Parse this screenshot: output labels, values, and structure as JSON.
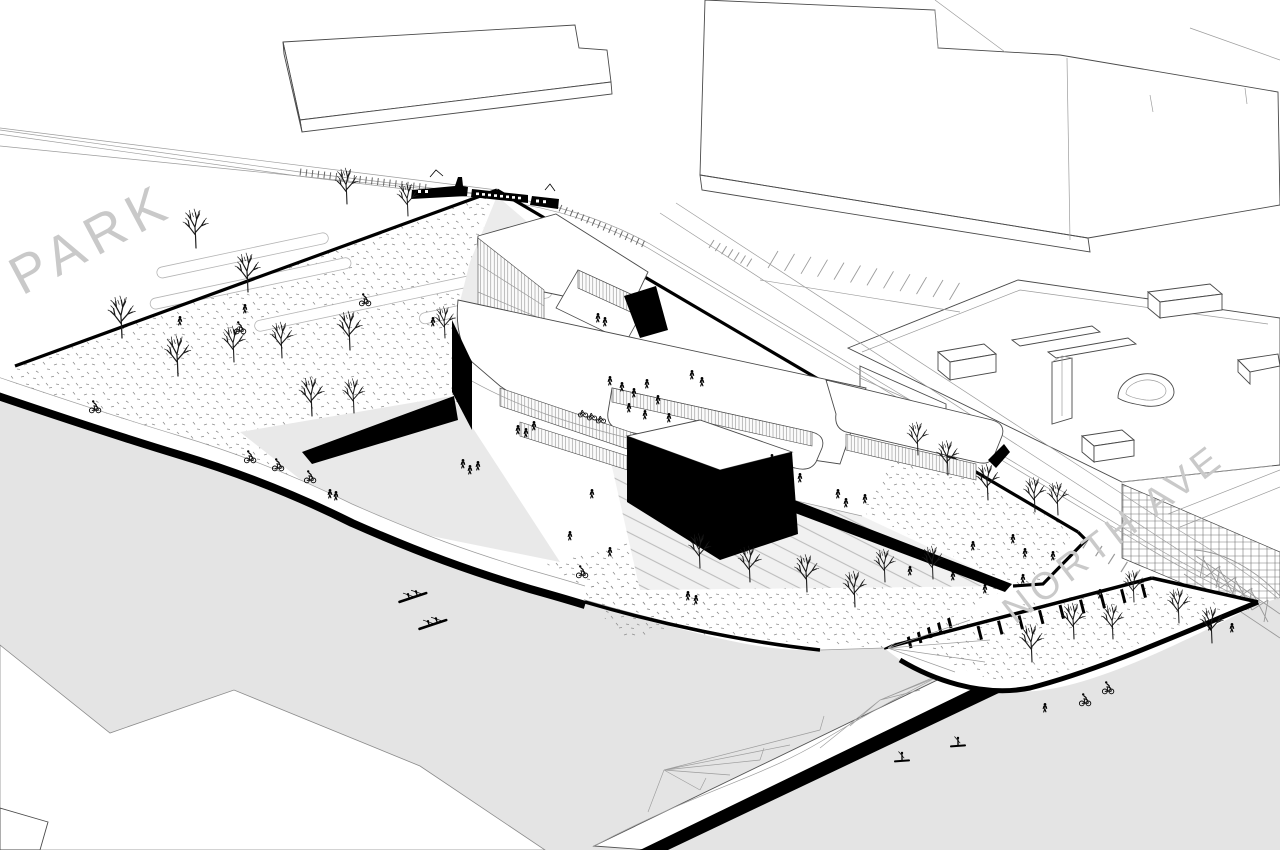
{
  "labels": {
    "park": "PARK",
    "north_ave": "NORTH AVE"
  },
  "colors": {
    "ink": "#000000",
    "outline": "#4a4a4a",
    "faint": "#9c9c9c",
    "river": "#e4e4e4",
    "path_gray": "#ececec",
    "slope_gray": "#e9e9e9",
    "glass": "#8a8a8a",
    "label_gray": "#c9c9c9",
    "paper": "#ffffff"
  },
  "scene": {
    "trees": [
      {
        "x": 347,
        "y": 204,
        "s": 1.2
      },
      {
        "x": 408,
        "y": 216,
        "s": 1.1
      },
      {
        "x": 196,
        "y": 248,
        "s": 1.3
      },
      {
        "x": 248,
        "y": 292,
        "s": 1.3
      },
      {
        "x": 122,
        "y": 338,
        "s": 1.4
      },
      {
        "x": 178,
        "y": 376,
        "s": 1.35
      },
      {
        "x": 234,
        "y": 362,
        "s": 1.2
      },
      {
        "x": 282,
        "y": 358,
        "s": 1.2
      },
      {
        "x": 350,
        "y": 350,
        "s": 1.3
      },
      {
        "x": 312,
        "y": 416,
        "s": 1.3
      },
      {
        "x": 354,
        "y": 413,
        "s": 1.15
      },
      {
        "x": 445,
        "y": 338,
        "s": 1.05
      },
      {
        "x": 918,
        "y": 455,
        "s": 1.1
      },
      {
        "x": 948,
        "y": 475,
        "s": 1.15
      },
      {
        "x": 988,
        "y": 500,
        "s": 1.2
      },
      {
        "x": 1035,
        "y": 512,
        "s": 1.15
      },
      {
        "x": 1058,
        "y": 515,
        "s": 1.1
      },
      {
        "x": 700,
        "y": 568,
        "s": 1.15
      },
      {
        "x": 750,
        "y": 582,
        "s": 1.2
      },
      {
        "x": 807,
        "y": 592,
        "s": 1.25
      },
      {
        "x": 855,
        "y": 607,
        "s": 1.2
      },
      {
        "x": 885,
        "y": 582,
        "s": 1.1
      },
      {
        "x": 933,
        "y": 579,
        "s": 1.1
      },
      {
        "x": 1032,
        "y": 662,
        "s": 1.25
      },
      {
        "x": 1074,
        "y": 639,
        "s": 1.2
      },
      {
        "x": 1113,
        "y": 639,
        "s": 1.15
      },
      {
        "x": 1134,
        "y": 602,
        "s": 1.05
      },
      {
        "x": 1179,
        "y": 623,
        "s": 1.15
      },
      {
        "x": 1212,
        "y": 643,
        "s": 1.2
      }
    ],
    "people": [
      {
        "x": 610,
        "y": 385
      },
      {
        "x": 622,
        "y": 391
      },
      {
        "x": 634,
        "y": 397
      },
      {
        "x": 647,
        "y": 388
      },
      {
        "x": 658,
        "y": 404
      },
      {
        "x": 629,
        "y": 412
      },
      {
        "x": 645,
        "y": 419
      },
      {
        "x": 669,
        "y": 422
      },
      {
        "x": 692,
        "y": 379
      },
      {
        "x": 702,
        "y": 386
      },
      {
        "x": 598,
        "y": 322
      },
      {
        "x": 605,
        "y": 326
      },
      {
        "x": 518,
        "y": 434
      },
      {
        "x": 526,
        "y": 437
      },
      {
        "x": 534,
        "y": 430
      },
      {
        "x": 463,
        "y": 468
      },
      {
        "x": 470,
        "y": 474
      },
      {
        "x": 478,
        "y": 470
      },
      {
        "x": 592,
        "y": 498
      },
      {
        "x": 570,
        "y": 540
      },
      {
        "x": 610,
        "y": 556
      },
      {
        "x": 688,
        "y": 600
      },
      {
        "x": 696,
        "y": 604
      },
      {
        "x": 772,
        "y": 463
      },
      {
        "x": 778,
        "y": 467
      },
      {
        "x": 786,
        "y": 475
      },
      {
        "x": 800,
        "y": 482
      },
      {
        "x": 838,
        "y": 498
      },
      {
        "x": 846,
        "y": 507
      },
      {
        "x": 865,
        "y": 503
      },
      {
        "x": 783,
        "y": 515
      },
      {
        "x": 973,
        "y": 550
      },
      {
        "x": 1013,
        "y": 543
      },
      {
        "x": 1025,
        "y": 557
      },
      {
        "x": 1053,
        "y": 560
      },
      {
        "x": 910,
        "y": 575
      },
      {
        "x": 953,
        "y": 580
      },
      {
        "x": 985,
        "y": 593
      },
      {
        "x": 1023,
        "y": 583
      },
      {
        "x": 1210,
        "y": 630
      },
      {
        "x": 1232,
        "y": 632
      },
      {
        "x": 1045,
        "y": 712
      },
      {
        "x": 1100,
        "y": 598
      },
      {
        "x": 330,
        "y": 498
      },
      {
        "x": 336,
        "y": 500
      },
      {
        "x": 180,
        "y": 325
      },
      {
        "x": 245,
        "y": 313
      },
      {
        "x": 433,
        "y": 326
      }
    ],
    "cyclists": [
      {
        "x": 95,
        "y": 412
      },
      {
        "x": 250,
        "y": 462
      },
      {
        "x": 278,
        "y": 470
      },
      {
        "x": 310,
        "y": 482
      },
      {
        "x": 240,
        "y": 333
      },
      {
        "x": 365,
        "y": 305
      },
      {
        "x": 582,
        "y": 577
      },
      {
        "x": 1085,
        "y": 705
      },
      {
        "x": 1108,
        "y": 693
      }
    ],
    "parked_bikes": [
      {
        "x": 583,
        "y": 415
      },
      {
        "x": 592,
        "y": 418
      },
      {
        "x": 601,
        "y": 421
      }
    ],
    "kayaks": [
      {
        "x": 413,
        "y": 598,
        "r": -14
      },
      {
        "x": 433,
        "y": 625,
        "r": -14
      }
    ],
    "paddleboarders": [
      {
        "x": 902,
        "y": 761
      },
      {
        "x": 958,
        "y": 746
      }
    ]
  }
}
